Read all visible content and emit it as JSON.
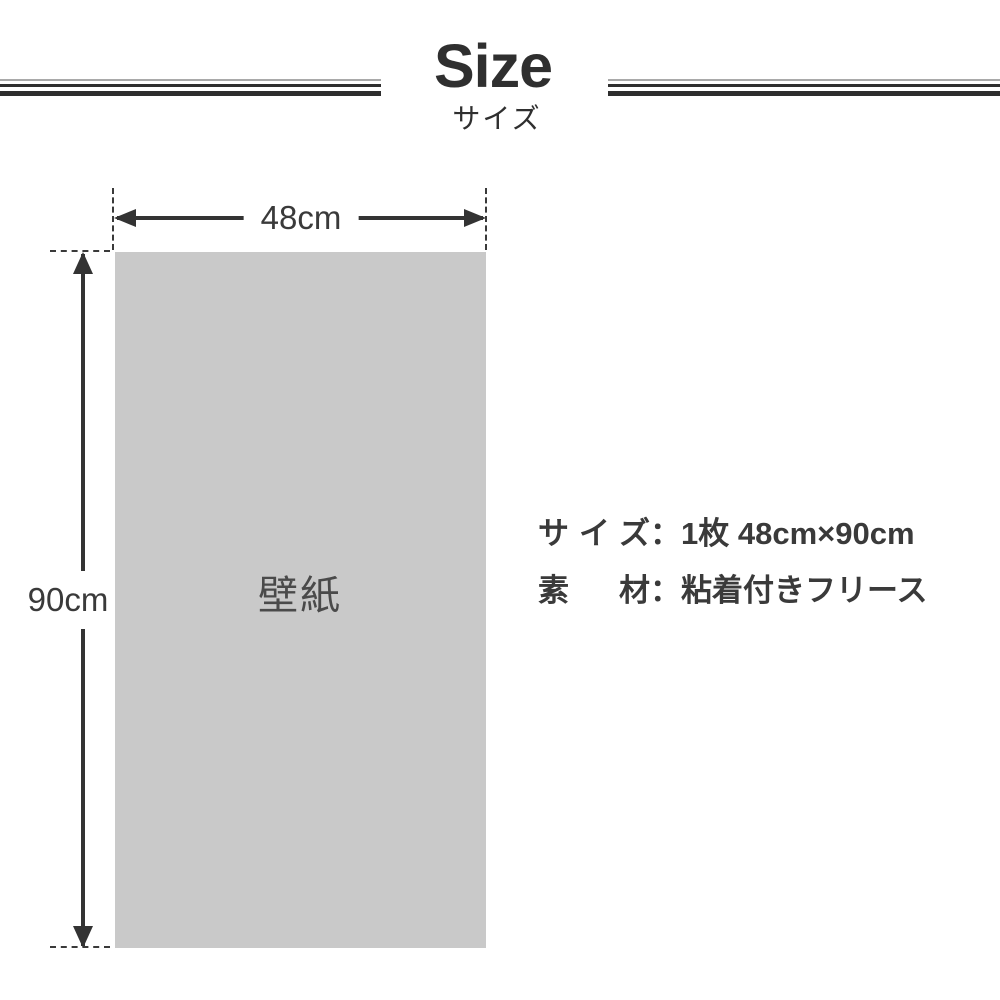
{
  "header": {
    "title": "Size",
    "subtitle": "サイズ"
  },
  "diagram": {
    "width_label": "48cm",
    "height_label": "90cm",
    "panel_label": "壁紙"
  },
  "specs": {
    "rows": [
      {
        "label": "サイズ",
        "value": "：1枚 48cm×90cm"
      },
      {
        "label": "素材",
        "value": "：粘着付きフリース"
      }
    ]
  },
  "colors": {
    "line_dark": "#2e2e2e",
    "line_thin_gray": "#a9a9a9",
    "arrow_dark": "#333333",
    "panel_fill": "#c9c9c9",
    "panel_text": "#4a4a4a",
    "spec_text": "#3a3a3a",
    "background": "#ffffff"
  }
}
